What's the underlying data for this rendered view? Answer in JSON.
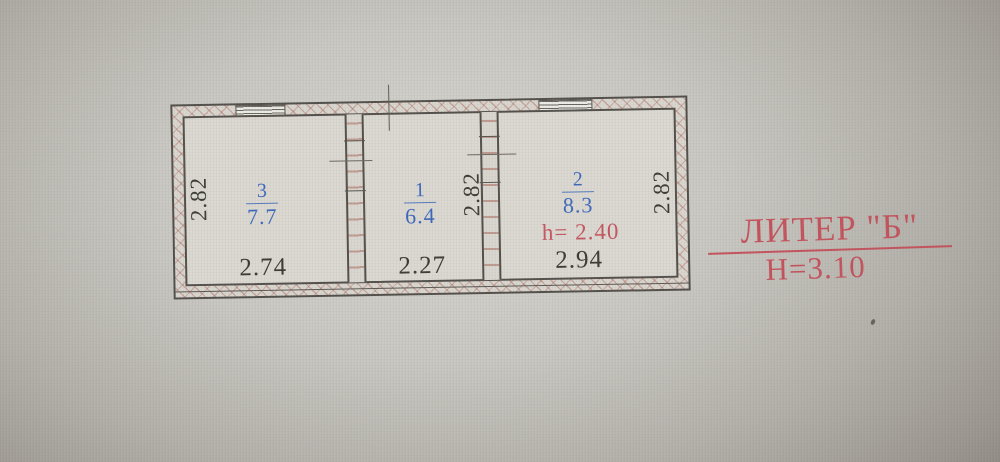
{
  "plan": {
    "rooms": [
      {
        "number": "3",
        "area": "7.7",
        "width_dim": "2.74",
        "height_dim": "2.82"
      },
      {
        "number": "1",
        "area": "6.4",
        "width_dim": "2.27",
        "height_dim": "2.82"
      },
      {
        "number": "2",
        "area": "8.3",
        "width_dim": "2.94",
        "height_dim": "2.82",
        "ceiling_height": "h= 2.40"
      }
    ],
    "symbols": {
      "window": "striped-rect",
      "wall_hatch": "red-cross-hatch"
    },
    "colors": {
      "room_label": "#3c68bb",
      "dimension_text": "#3b3933",
      "annotation_red": "#c3525c",
      "wall_line": "#514e49",
      "wall_hatch": "#9e5040",
      "paper": "#dbd8d2"
    }
  },
  "annotation": {
    "title": "ЛИТЕР \"Б\"",
    "height": "Н=3.10"
  }
}
